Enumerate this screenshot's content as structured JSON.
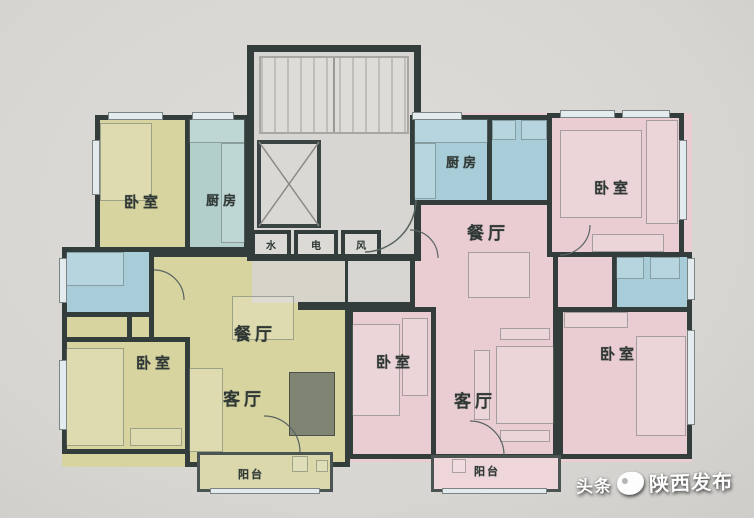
{
  "plan": {
    "left_unit": {
      "bedroom_top": "卧室",
      "kitchen": "厨房",
      "dining": "餐厅",
      "living": "客厅",
      "bedroom_bottom": "卧室",
      "balcony": "阳台"
    },
    "right_unit": {
      "kitchen": "厨房",
      "bedroom_top": "卧室",
      "dining": "餐厅",
      "bedroom_left": "卧室",
      "living": "客厅",
      "bedroom_right": "卧室",
      "balcony": "阳台"
    },
    "core": {
      "shaft_water": "水",
      "shaft_electric": "电",
      "shaft_vent": "风"
    }
  },
  "watermark": {
    "platform": "头条",
    "account": "陕西发布"
  },
  "colors": {
    "left_unit_floor": "#d7d4a0",
    "right_unit_floor": "#e9cdd2",
    "wet_room_floor": "#a9cdd8",
    "wall": "#333e3c",
    "background": "#d8d6d2",
    "watermark_text": "#fdfdfd"
  }
}
